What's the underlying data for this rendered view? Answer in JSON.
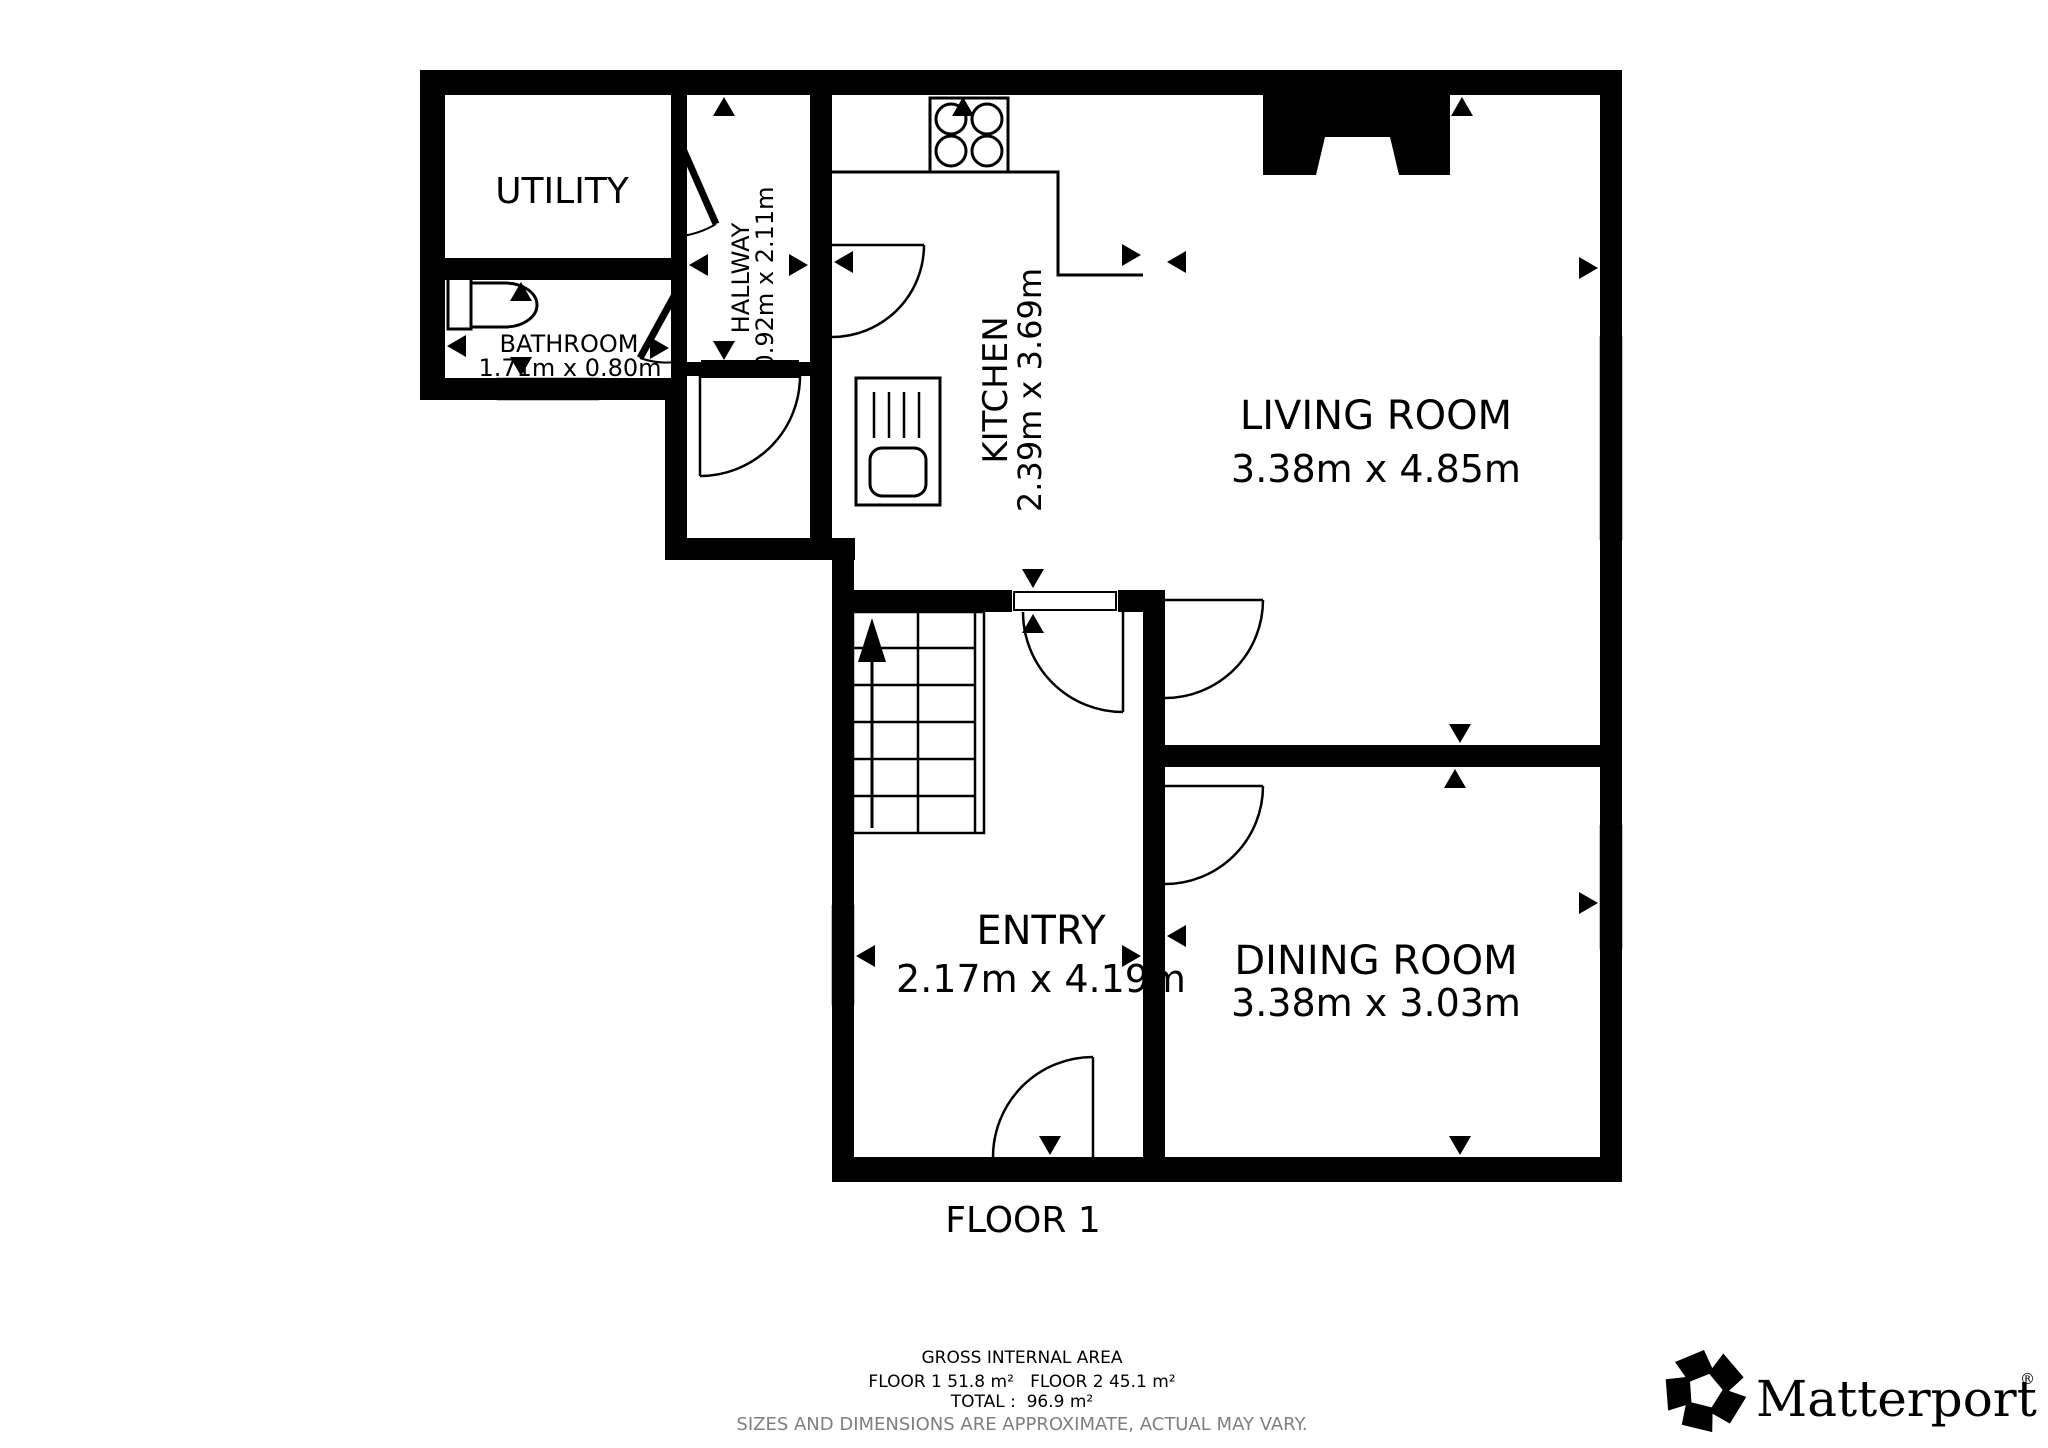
{
  "page": {
    "background": "#ffffff",
    "wall_color": "#000000",
    "muted_text_color": "#7f7f7f"
  },
  "plan": {
    "floor_label": "FLOOR 1",
    "rooms": [
      {
        "id": "utility",
        "name": "UTILITY",
        "dims": ""
      },
      {
        "id": "hallway",
        "name": "HALLWAY",
        "dims": "0.92m x 2.11m"
      },
      {
        "id": "bathroom",
        "name": "BATHROOM",
        "dims": "1.71m x 0.80m"
      },
      {
        "id": "kitchen",
        "name": "KITCHEN",
        "dims": "2.39m x 3.69m"
      },
      {
        "id": "living",
        "name": "LIVING ROOM",
        "dims": "3.38m x 4.85m"
      },
      {
        "id": "entry",
        "name": "ENTRY",
        "dims": "2.17m x 4.19m"
      },
      {
        "id": "dining",
        "name": "DINING ROOM",
        "dims": "3.38m x 3.03m"
      }
    ],
    "icons": [
      "stove-icon",
      "sink-icon",
      "toilet-icon",
      "stairs-up-arrow-icon",
      "door-swing-icon",
      "window-icon",
      "fireplace-icon",
      "measure-arrow-icon"
    ]
  },
  "footer": {
    "gross_title": "GROSS INTERNAL AREA",
    "floor_areas": "FLOOR 1 51.8 m²   FLOOR 2 45.1 m²",
    "total": "TOTAL :  96.9 m²",
    "disclaimer": "SIZES AND DIMENSIONS ARE APPROXIMATE, ACTUAL MAY VARY."
  },
  "branding": {
    "logo_text": "Matterport",
    "registered_mark": "®"
  }
}
